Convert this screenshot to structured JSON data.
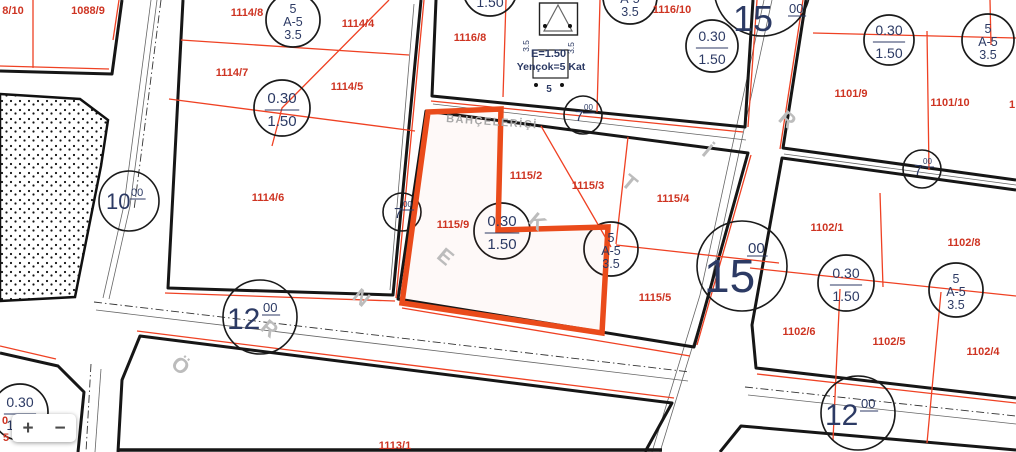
{
  "colors": {
    "highlight_orange": "#ea4b1b",
    "cadastral_line_red": "#ef4123",
    "parcel_number_red": "#ce3422",
    "zoning_text_navy": "#2c3a64",
    "line_black": "#161616",
    "watermark_gray": "#bcbcbc",
    "street_gray": "#a8a8a8"
  },
  "watermark": {
    "text": "ÖRNEKTİR",
    "letters": [
      {
        "ch": "Ö",
        "x": 176,
        "y": 371
      },
      {
        "ch": "R",
        "x": 265,
        "y": 334
      },
      {
        "ch": "N",
        "x": 357,
        "y": 303
      },
      {
        "ch": "E",
        "x": 441,
        "y": 262
      },
      {
        "ch": "K",
        "x": 533,
        "y": 227
      },
      {
        "ch": "T",
        "x": 625,
        "y": 188
      },
      {
        "ch": "İ",
        "x": 703,
        "y": 156
      },
      {
        "ch": "R",
        "x": 783,
        "y": 125
      }
    ]
  },
  "street": {
    "label": "BAHÇELERİÇİ"
  },
  "envelope": {
    "parcel": "1116/7",
    "side_left": "3.5",
    "side_right": "3.5",
    "emsal": "E=1.50",
    "height": "Yençok=5 Kat",
    "front": "5"
  },
  "parcel_labels": [
    {
      "text": "8/10",
      "x": 13,
      "y": 14
    },
    {
      "text": "1088/9",
      "x": 88,
      "y": 14
    },
    {
      "text": "1114/8",
      "x": 247,
      "y": 16
    },
    {
      "text": "1114/4",
      "x": 358,
      "y": 27
    },
    {
      "text": "1114/7",
      "x": 232,
      "y": 76
    },
    {
      "text": "1114/5",
      "x": 347,
      "y": 90
    },
    {
      "text": "1114/6",
      "x": 268,
      "y": 201
    },
    {
      "text": "1116/8",
      "x": 470,
      "y": 41
    },
    {
      "text": "1116/10",
      "x": 672,
      "y": 13
    },
    {
      "text": "1101/9",
      "x": 851,
      "y": 97
    },
    {
      "text": "1101/10",
      "x": 950,
      "y": 106
    },
    {
      "text": "1115/9",
      "x": 453,
      "y": 228
    },
    {
      "text": "1115/2",
      "x": 526,
      "y": 179
    },
    {
      "text": "1115/3",
      "x": 588,
      "y": 189
    },
    {
      "text": "1115/4",
      "x": 673,
      "y": 202
    },
    {
      "text": "1115/5",
      "x": 655,
      "y": 301
    },
    {
      "text": "1102/1",
      "x": 827,
      "y": 231
    },
    {
      "text": "1102/8",
      "x": 964,
      "y": 246
    },
    {
      "text": "1102/6",
      "x": 799,
      "y": 335
    },
    {
      "text": "1102/5",
      "x": 889,
      "y": 345
    },
    {
      "text": "1102/4",
      "x": 983,
      "y": 355
    },
    {
      "text": "1113/1",
      "x": 395,
      "y": 449
    },
    {
      "text": "1",
      "x": 1012,
      "y": 108
    },
    {
      "text": "0",
      "x": 5,
      "y": 424
    },
    {
      "text": "5",
      "x": 6,
      "y": 441
    }
  ],
  "road_labels": [
    {
      "value": "10",
      "sup": "00",
      "cx": 129,
      "cy": 201,
      "r": 30,
      "size": 22,
      "supsize": 11,
      "tx": 106,
      "ty": 209,
      "sx": 131,
      "sy": 196
    },
    {
      "value": "7",
      "sup": "00",
      "cx": 402,
      "cy": 212,
      "r": 19,
      "size": 15,
      "supsize": 8,
      "tx": 394,
      "ty": 218,
      "sx": 403,
      "sy": 207
    },
    {
      "value": "7",
      "sup": "00",
      "cx": 583,
      "cy": 115,
      "r": 19,
      "size": 15,
      "supsize": 8,
      "tx": 575,
      "ty": 121,
      "sx": 584,
      "sy": 110
    },
    {
      "value": "7",
      "sup": "00",
      "cx": 922,
      "cy": 169,
      "r": 19,
      "size": 15,
      "supsize": 8,
      "tx": 914,
      "ty": 175,
      "sx": 923,
      "sy": 164
    },
    {
      "value": "12",
      "sup": "00",
      "cx": 260,
      "cy": 317,
      "r": 37,
      "size": 30,
      "supsize": 13,
      "tx": 227,
      "ty": 329,
      "sx": 263,
      "sy": 312
    },
    {
      "value": "12",
      "sup": "00",
      "cx": 858,
      "cy": 413,
      "r": 37,
      "size": 30,
      "supsize": 13,
      "tx": 825,
      "ty": 425,
      "sx": 861,
      "sy": 408
    },
    {
      "value": "15",
      "sup": "00",
      "cx": 762,
      "cy": -12,
      "r": 48,
      "size": 36,
      "supsize": 13,
      "tx": 733,
      "ty": 31,
      "sx": 789,
      "sy": 13
    },
    {
      "value": "15",
      "sup": "00",
      "cx": 742,
      "cy": 266,
      "r": 45,
      "size": 46,
      "supsize": 15,
      "tx": 704,
      "ty": 292,
      "sx": 748,
      "sy": 253
    }
  ],
  "ratio_circles": [
    {
      "top": "0.30",
      "bottom": "1.50",
      "cx": 282,
      "cy": 108,
      "r": 28,
      "f": 15
    },
    {
      "top": "0.30",
      "bottom": "1.50",
      "cx": 712,
      "cy": 46,
      "r": 26,
      "f": 14
    },
    {
      "top": "0.30",
      "bottom": "1.50",
      "cx": 889,
      "cy": 40,
      "r": 25,
      "f": 14
    },
    {
      "top": "0.30",
      "bottom": "1.50",
      "cx": 502,
      "cy": 231,
      "r": 28,
      "f": 15
    },
    {
      "top": "0.30",
      "bottom": "1.50",
      "cx": 846,
      "cy": 283,
      "r": 28,
      "f": 14
    },
    {
      "top": "0.30",
      "bottom": "1.50",
      "cx": 20,
      "cy": 412,
      "r": 28,
      "f": 14
    },
    {
      "top": "0.30",
      "bottom": "1.50",
      "cx": 490,
      "cy": -11,
      "r": 27,
      "f": 14
    }
  ],
  "zone_circles": [
    {
      "l1": "5",
      "l2": "A-5",
      "l3": "3.5",
      "cx": 293,
      "cy": 20,
      "r": 27
    },
    {
      "l1": "5",
      "l2": "A-5",
      "l3": "3.5",
      "cx": 630,
      "cy": -3,
      "r": 27
    },
    {
      "l1": "5",
      "l2": "A-5",
      "l3": "3.5",
      "cx": 988,
      "cy": 40,
      "r": 26
    },
    {
      "l1": "5",
      "l2": "A-5",
      "l3": "3.5",
      "cx": 611,
      "cy": 249,
      "r": 27
    },
    {
      "l1": "5",
      "l2": "A-5",
      "l3": "3.5",
      "cx": 956,
      "cy": 290,
      "r": 27
    }
  ],
  "controls": {
    "zoom_in": "+",
    "zoom_out": "−"
  }
}
